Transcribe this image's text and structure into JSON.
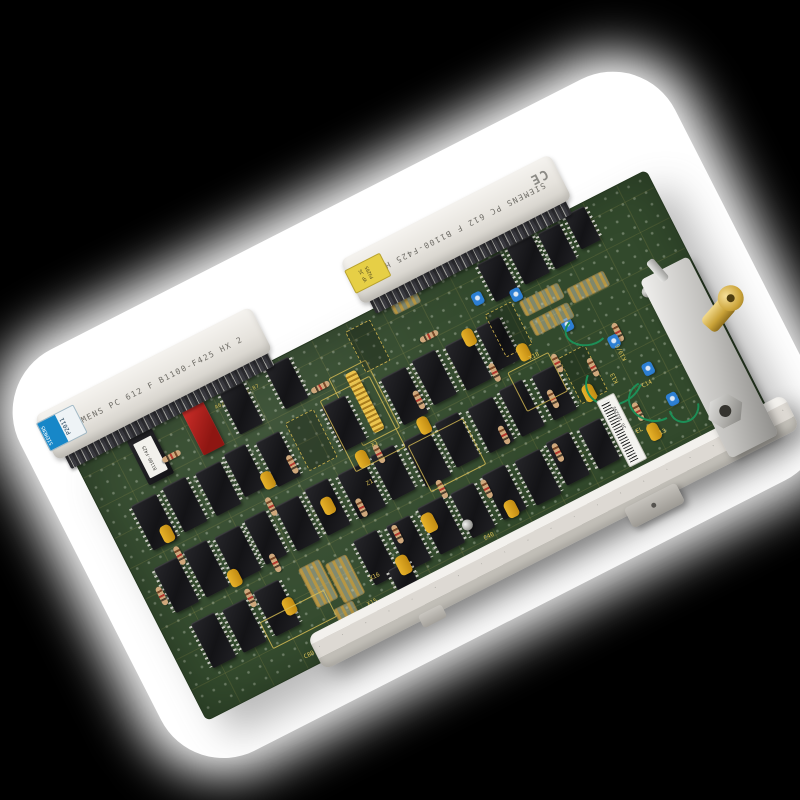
{
  "scene": {
    "type": "circuit-board-photo",
    "background_color": "#000000",
    "cutout_color": "#ffffff",
    "pcb_color": "#32492c",
    "silkscreen_color": "#dcc257"
  },
  "labels": {
    "left_connector_text": "SIEMENS PC 612 F B1100-F425 HX 2",
    "top_connector_text": "SIEMENS PC 612 F B1100-F425 HX 2",
    "blue_brand": "SIEMENS",
    "blue_code": "P2011",
    "yellow_line1": "VP JG",
    "yellow_line2": "P3205",
    "ce_mark": "CE",
    "barcode_text": "JG 103295",
    "eprom_text": "B1100-F425"
  },
  "board": {
    "silkscreen_part": "A62-C742-02-87"
  },
  "components": {
    "ics": [
      {
        "x": 160,
        "y": 6,
        "w": 26,
        "h": 46
      },
      {
        "x": 212,
        "y": 4,
        "w": 26,
        "h": 46
      },
      {
        "x": 448,
        "y": 8,
        "w": 26,
        "h": 42
      },
      {
        "x": 482,
        "y": 6,
        "w": 28,
        "h": 42
      },
      {
        "x": 516,
        "y": 8,
        "w": 24,
        "h": 40
      },
      {
        "x": 548,
        "y": 4,
        "w": 22,
        "h": 38
      },
      {
        "x": 30,
        "y": 66,
        "w": 28,
        "h": 50
      },
      {
        "x": 66,
        "y": 64,
        "w": 26,
        "h": 50
      },
      {
        "x": 102,
        "y": 66,
        "w": 28,
        "h": 48
      },
      {
        "x": 136,
        "y": 62,
        "w": 24,
        "h": 48
      },
      {
        "x": 170,
        "y": 66,
        "w": 26,
        "h": 50
      },
      {
        "x": 245,
        "y": 64,
        "w": 26,
        "h": 50
      },
      {
        "x": 310,
        "y": 66,
        "w": 28,
        "h": 52
      },
      {
        "x": 346,
        "y": 64,
        "w": 26,
        "h": 50
      },
      {
        "x": 382,
        "y": 66,
        "w": 28,
        "h": 50
      },
      {
        "x": 418,
        "y": 64,
        "w": 26,
        "h": 48
      },
      {
        "x": 22,
        "y": 132,
        "w": 26,
        "h": 50
      },
      {
        "x": 56,
        "y": 130,
        "w": 26,
        "h": 52
      },
      {
        "x": 90,
        "y": 132,
        "w": 28,
        "h": 50
      },
      {
        "x": 124,
        "y": 130,
        "w": 24,
        "h": 50
      },
      {
        "x": 158,
        "y": 132,
        "w": 26,
        "h": 50
      },
      {
        "x": 192,
        "y": 130,
        "w": 26,
        "h": 52
      },
      {
        "x": 228,
        "y": 132,
        "w": 30,
        "h": 50
      },
      {
        "x": 266,
        "y": 130,
        "w": 26,
        "h": 50
      },
      {
        "x": 302,
        "y": 132,
        "w": 28,
        "h": 52
      },
      {
        "x": 338,
        "y": 130,
        "w": 26,
        "h": 50
      },
      {
        "x": 374,
        "y": 132,
        "w": 28,
        "h": 50
      },
      {
        "x": 410,
        "y": 130,
        "w": 26,
        "h": 52
      },
      {
        "x": 446,
        "y": 132,
        "w": 26,
        "h": 50
      },
      {
        "x": 30,
        "y": 198,
        "w": 26,
        "h": 50
      },
      {
        "x": 64,
        "y": 200,
        "w": 26,
        "h": 48
      },
      {
        "x": 100,
        "y": 198,
        "w": 28,
        "h": 50
      },
      {
        "x": 212,
        "y": 198,
        "w": 26,
        "h": 50
      },
      {
        "x": 248,
        "y": 200,
        "w": 26,
        "h": 50
      },
      {
        "x": 284,
        "y": 198,
        "w": 28,
        "h": 52
      },
      {
        "x": 320,
        "y": 200,
        "w": 26,
        "h": 50
      },
      {
        "x": 356,
        "y": 198,
        "w": 26,
        "h": 50
      },
      {
        "x": 392,
        "y": 200,
        "w": 28,
        "h": 50
      },
      {
        "x": 428,
        "y": 198,
        "w": 26,
        "h": 48
      },
      {
        "x": 464,
        "y": 200,
        "w": 24,
        "h": 46
      },
      {
        "x": 230,
        "y": 240,
        "w": 22,
        "h": 34
      }
    ],
    "sockets": [
      {
        "x": 205,
        "y": 62,
        "w": 30,
        "h": 52
      },
      {
        "x": 432,
        "y": 56,
        "w": 28,
        "h": 46
      },
      {
        "x": 300,
        "y": 8,
        "w": 26,
        "h": 44
      },
      {
        "x": 478,
        "y": 128,
        "w": 28,
        "h": 50
      }
    ],
    "caps": [
      {
        "x": 44,
        "y": 98,
        "w": 12,
        "h": 18
      },
      {
        "x": 84,
        "y": 168,
        "w": 12,
        "h": 18
      },
      {
        "x": 120,
        "y": 218,
        "w": 12,
        "h": 18
      },
      {
        "x": 158,
        "y": 96,
        "w": 12,
        "h": 18
      },
      {
        "x": 200,
        "y": 146,
        "w": 12,
        "h": 18
      },
      {
        "x": 240,
        "y": 232,
        "w": 13,
        "h": 20
      },
      {
        "x": 282,
        "y": 206,
        "w": 13,
        "h": 20
      },
      {
        "x": 322,
        "y": 118,
        "w": 12,
        "h": 18
      },
      {
        "x": 362,
        "y": 232,
        "w": 12,
        "h": 18
      },
      {
        "x": 402,
        "y": 60,
        "w": 12,
        "h": 18
      },
      {
        "x": 444,
        "y": 98,
        "w": 12,
        "h": 18
      },
      {
        "x": 484,
        "y": 164,
        "w": 12,
        "h": 18
      },
      {
        "x": 524,
        "y": 228,
        "w": 12,
        "h": 18
      },
      {
        "x": 252,
        "y": 120,
        "w": 12,
        "h": 18
      }
    ],
    "resistors": [
      {
        "x": 14,
        "y": 150,
        "w": 6,
        "h": 20
      },
      {
        "x": 48,
        "y": 122,
        "w": 6,
        "h": 20
      },
      {
        "x": 92,
        "y": 192,
        "w": 6,
        "h": 20
      },
      {
        "x": 130,
        "y": 172,
        "w": 6,
        "h": 20
      },
      {
        "x": 152,
        "y": 120,
        "w": 6,
        "h": 20
      },
      {
        "x": 190,
        "y": 92,
        "w": 6,
        "h": 20
      },
      {
        "x": 232,
        "y": 162,
        "w": 6,
        "h": 20
      },
      {
        "x": 252,
        "y": 202,
        "w": 6,
        "h": 20
      },
      {
        "x": 272,
        "y": 122,
        "w": 6,
        "h": 20
      },
      {
        "x": 312,
        "y": 182,
        "w": 6,
        "h": 20
      },
      {
        "x": 332,
        "y": 92,
        "w": 6,
        "h": 20
      },
      {
        "x": 352,
        "y": 202,
        "w": 6,
        "h": 20
      },
      {
        "x": 392,
        "y": 162,
        "w": 6,
        "h": 20
      },
      {
        "x": 412,
        "y": 102,
        "w": 6,
        "h": 20
      },
      {
        "x": 432,
        "y": 202,
        "w": 6,
        "h": 20
      },
      {
        "x": 452,
        "y": 152,
        "w": 6,
        "h": 20
      },
      {
        "x": 472,
        "y": 122,
        "w": 6,
        "h": 20
      },
      {
        "x": 502,
        "y": 142,
        "w": 6,
        "h": 20
      },
      {
        "x": 522,
        "y": 202,
        "w": 6,
        "h": 20
      },
      {
        "x": 540,
        "y": 122,
        "w": 6,
        "h": 20
      },
      {
        "x": 250,
        "y": 36,
        "w": 6,
        "h": 20,
        "r": 90
      },
      {
        "x": 370,
        "y": 40,
        "w": 6,
        "h": 20,
        "r": 90
      },
      {
        "x": 86,
        "y": 30,
        "w": 6,
        "h": 20,
        "r": 90
      }
    ],
    "trimmers": [
      {
        "x": 428,
        "y": 32,
        "w": 11,
        "h": 13
      },
      {
        "x": 464,
        "y": 46,
        "w": 11,
        "h": 13
      },
      {
        "x": 496,
        "y": 96,
        "w": 11,
        "h": 13
      },
      {
        "x": 530,
        "y": 132,
        "w": 11,
        "h": 13
      },
      {
        "x": 548,
        "y": 172,
        "w": 11,
        "h": 13
      },
      {
        "x": 556,
        "y": 210,
        "w": 11,
        "h": 13
      }
    ],
    "jumpers": [
      {
        "x": 150,
        "y": 198,
        "w": 22,
        "h": 42
      },
      {
        "x": 176,
        "y": 206,
        "w": 22,
        "h": 42
      },
      {
        "x": 163,
        "y": 250,
        "w": 20,
        "h": 36
      },
      {
        "x": 468,
        "y": 60,
        "w": 42,
        "h": 15
      },
      {
        "x": 468,
        "y": 82,
        "w": 42,
        "h": 15
      },
      {
        "x": 516,
        "y": 70,
        "w": 40,
        "h": 15
      },
      {
        "x": 352,
        "y": 2,
        "w": 28,
        "h": 12
      }
    ],
    "silk_boxes": [
      {
        "x": 246,
        "y": 58,
        "w": 54,
        "h": 78
      },
      {
        "x": 304,
        "y": 138,
        "w": 60,
        "h": 50
      },
      {
        "x": 92,
        "y": 228,
        "w": 70,
        "h": 28
      },
      {
        "x": 426,
        "y": 118,
        "w": 44,
        "h": 42
      }
    ],
    "refs": [
      {
        "t": "X1",
        "x": 272,
        "y": 118
      },
      {
        "t": "Z1",
        "x": 250,
        "y": 150
      },
      {
        "t": "X14",
        "x": 166,
        "y": 280
      },
      {
        "t": "X15",
        "x": 196,
        "y": 258
      },
      {
        "t": "X16",
        "x": 210,
        "y": 236
      },
      {
        "t": "C80",
        "x": 116,
        "y": 276
      },
      {
        "t": "C40",
        "x": 330,
        "y": 252
      },
      {
        "t": "X18",
        "x": 452,
        "y": 112
      },
      {
        "t": "K13",
        "x": 514,
        "y": 168,
        "r": -90
      },
      {
        "t": "K19/6",
        "x": 528,
        "y": 148,
        "r": -90
      },
      {
        "t": "C14",
        "x": 540,
        "y": 188
      },
      {
        "t": "EL",
        "x": 514,
        "y": 226
      },
      {
        "t": "13",
        "x": 534,
        "y": 238
      }
    ],
    "wires": [
      {
        "x": 488,
        "y": 148,
        "w": 56,
        "h": 46
      },
      {
        "x": 518,
        "y": 188,
        "w": 46,
        "h": 38,
        "r": 40
      },
      {
        "x": 552,
        "y": 214,
        "w": 28,
        "h": 26,
        "r": -30
      },
      {
        "x": 494,
        "y": 100,
        "w": 40,
        "h": 28,
        "r": 20
      }
    ],
    "screws": [
      {
        "x": 152,
        "y": 274
      },
      {
        "x": 316,
        "y": 230
      },
      {
        "x": 582,
        "y": 104
      }
    ]
  }
}
